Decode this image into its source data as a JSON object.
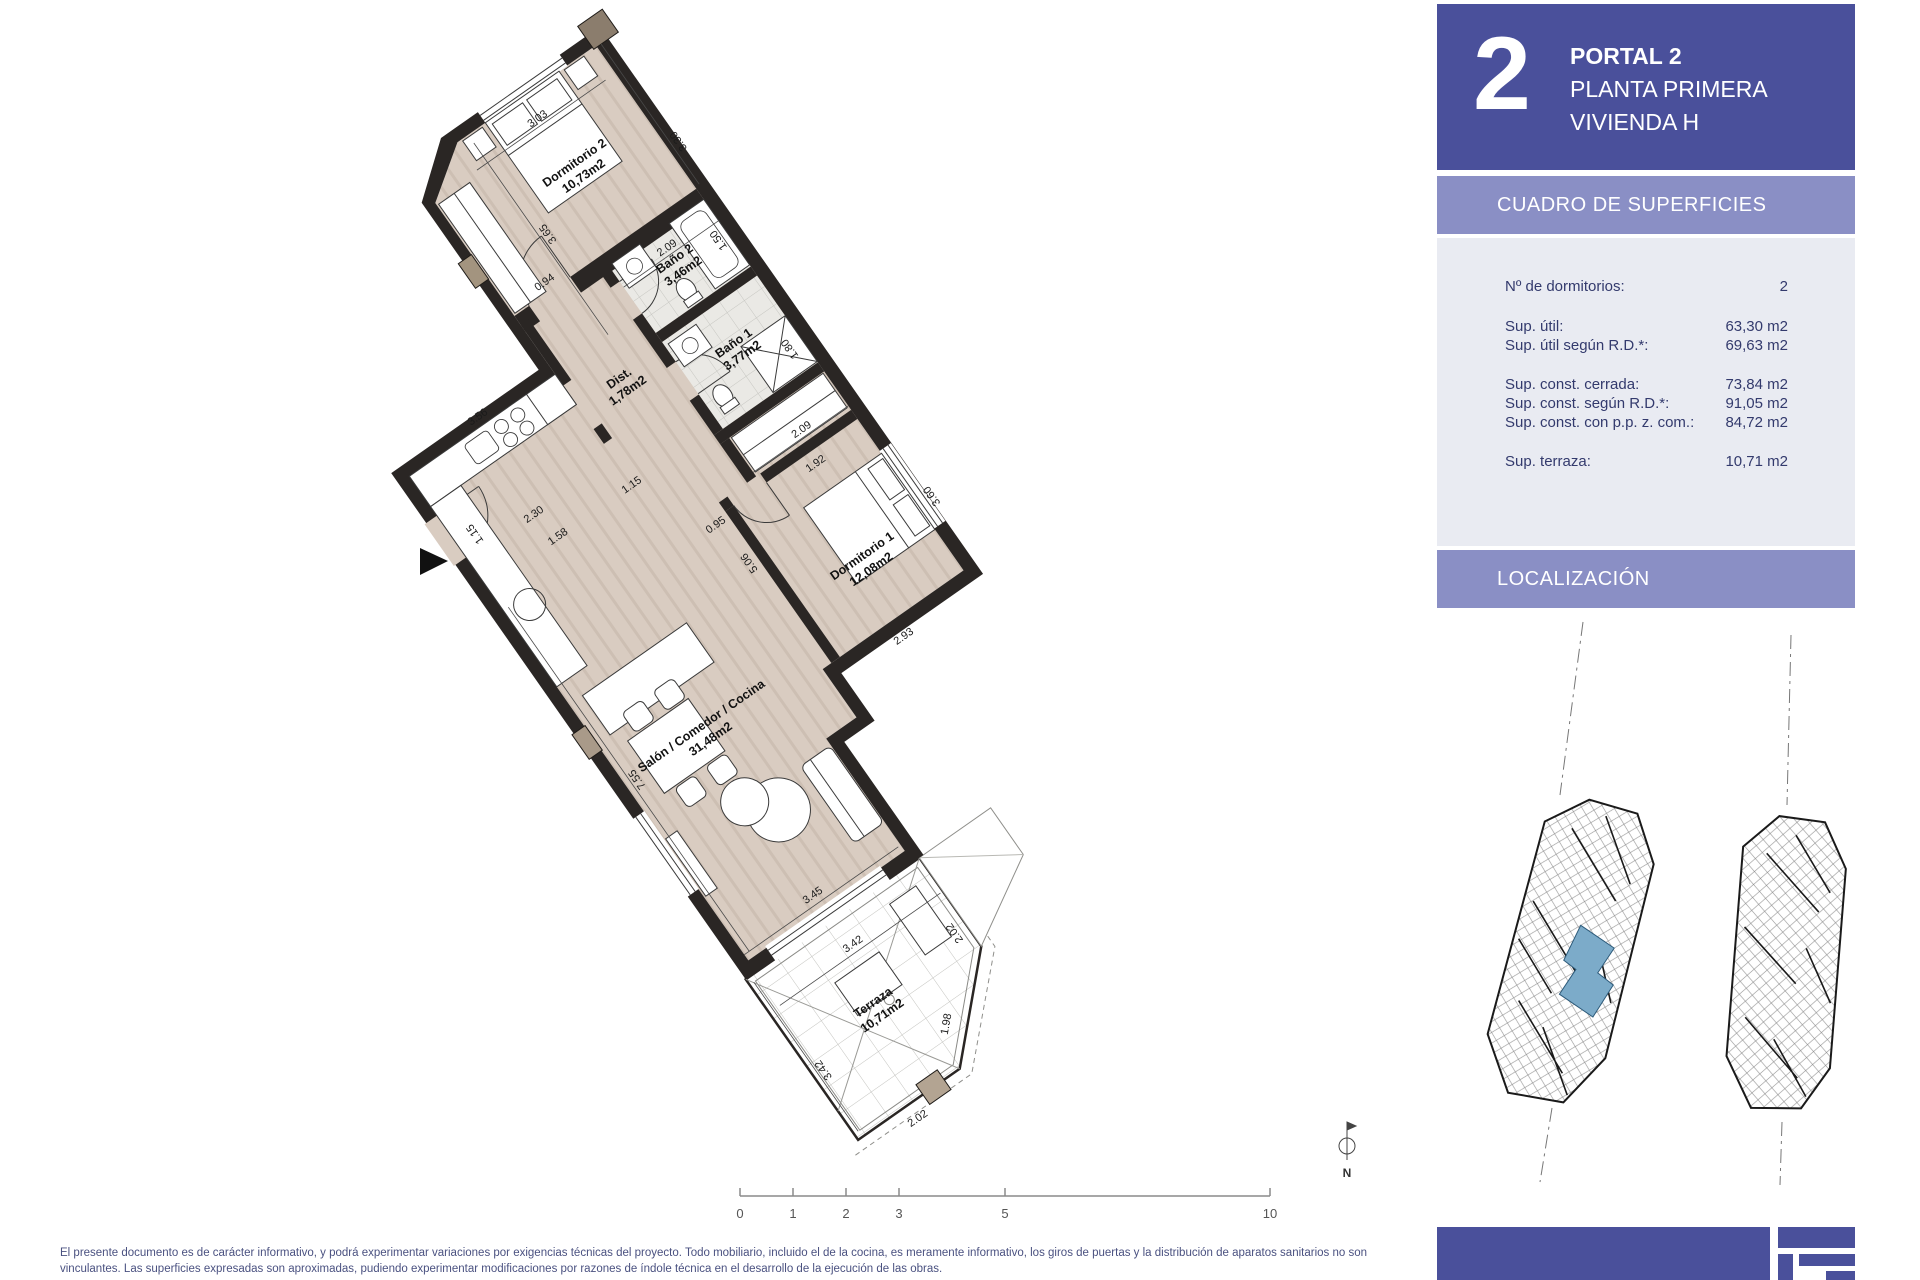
{
  "colors": {
    "panel_blue": "#4a509b",
    "band_purple": "#8a8fc5",
    "table_bg": "#e9ebf2",
    "table_text": "#333a6d",
    "floor_beige": "#d9ccc1",
    "wall_black": "#2a2624",
    "unit_highlight": "#7cabc9"
  },
  "panel": {
    "portal_big": "2",
    "title": [
      "PORTAL 2",
      "PLANTA PRIMERA",
      "VIVIENDA H"
    ],
    "superficies_header": "CUADRO DE SUPERFICIES",
    "table": {
      "rows": [
        {
          "label": "Nº de dormitorios:",
          "value": "2"
        },
        {
          "label": "Sup. útil:",
          "value": "63,30 m2"
        },
        {
          "label": "Sup. útil según R.D.*:",
          "value": "69,63 m2"
        },
        {
          "label": "Sup. const. cerrada:",
          "value": "73,84 m2"
        },
        {
          "label": "Sup. const. según R.D.*:",
          "value": "91,05 m2"
        },
        {
          "label": "Sup. const. con p.p. z. com.:",
          "value": "84,72 m2"
        },
        {
          "label": "Sup. terraza:",
          "value": "10,71 m2"
        }
      ]
    },
    "localizacion_header": "LOCALIZACIÓN"
  },
  "plan": {
    "rooms": [
      {
        "name": "Dormitorio 2",
        "area": "10,73m2"
      },
      {
        "name": "Baño 2",
        "area": "3,46m2"
      },
      {
        "name": "Dist.",
        "area": "1,78m2"
      },
      {
        "name": "Baño 1",
        "area": "3,77m2"
      },
      {
        "name": "Dormitorio 1",
        "area": "12,08m2"
      },
      {
        "name": "Salón / Comedor / Cocina",
        "area": "31,48m2"
      },
      {
        "name": "Terraza",
        "area": "10,71m2"
      }
    ],
    "dims": {
      "dorm2_w": "3.03",
      "dorm2_h": "3.30",
      "dorm2_l": "3.65",
      "bano2_w": "2.09",
      "door": "0.94",
      "bano2_h": "1.50",
      "bano1_h": "1.80",
      "bano1_w": "2.09",
      "pas": "1.92",
      "p115a": "1.15",
      "p115b": "1.15",
      "k230": "2.30",
      "k158": "1.58",
      "hall": "3.56",
      "corr": "0.95",
      "salon_r": "5.06",
      "dorm1_h": "3.60",
      "dorm1_w": "2.93",
      "salon_l": "7.55",
      "salon_w": "3.45",
      "terr_t": "3.42",
      "terr_l": "3.42",
      "terr_b": "2.02",
      "terr_r": "2.02",
      "terr_ch": "1.98"
    }
  },
  "scalebar": {
    "ticks": [
      "0",
      "1",
      "2",
      "3",
      "5",
      "10"
    ]
  },
  "compass": {
    "north": "N"
  },
  "footer": {
    "line1": "El presente documento es de carácter informativo, y podrá experimentar variaciones por exigencias técnicas del proyecto. Todo mobiliario, incluido el de la cocina, es meramente informativo, los giros de puertas y la distribución de aparatos sanitarios no son",
    "line2": "vinculantes. Las superficies expresadas son aproximadas, pudiendo experimentar modificaciones por razones de índole técnica en el desarrollo de la ejecución de las obras."
  }
}
